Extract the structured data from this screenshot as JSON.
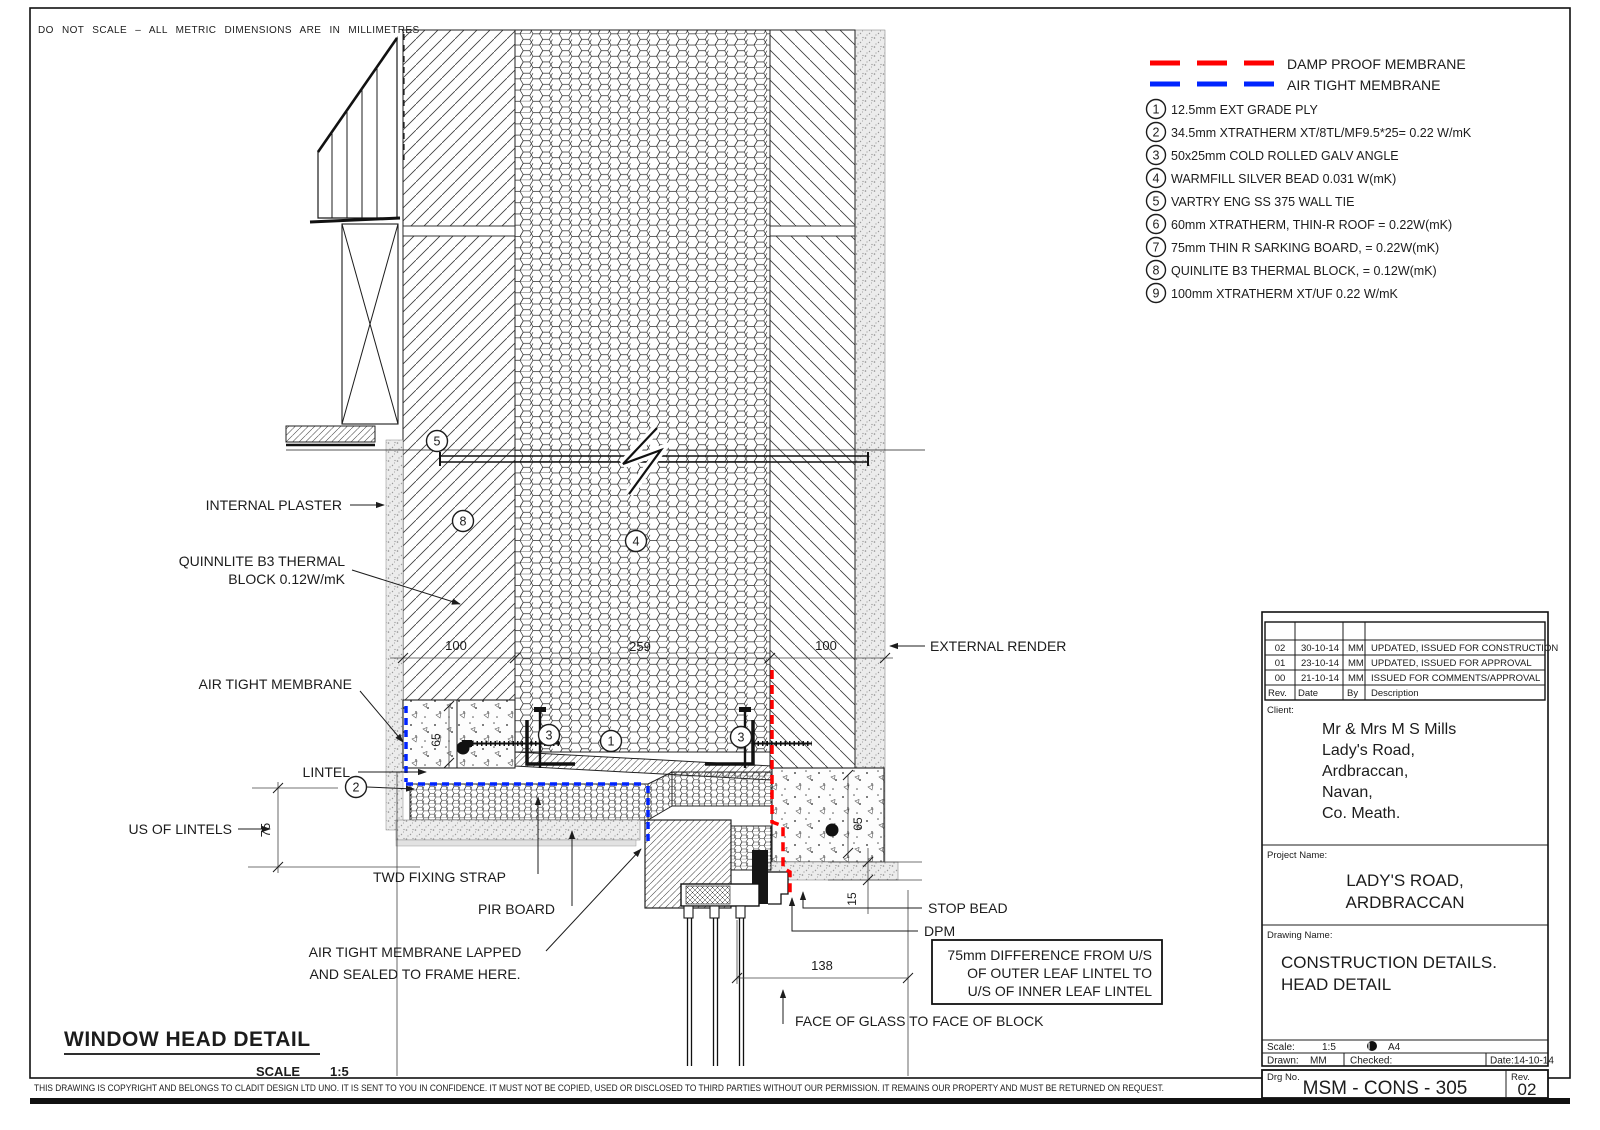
{
  "page": {
    "top_note": "DO NOT SCALE  –  ALL METRIC DIMENSIONS ARE IN MILLIMETRES",
    "copyright": "THIS DRAWING IS COPYRIGHT AND BELONGS TO CLADIT DESIGN LTD UNO.  IT IS SENT TO YOU IN CONFIDENCE.  IT MUST NOT BE COPIED, USED OR DISCLOSED TO THIRD PARTIES WITHOUT OUR PERMISSION.  IT REMAINS OUR PROPERTY AND MUST BE RETURNED ON REQUEST."
  },
  "legend": {
    "dpm_label": "DAMP PROOF MEMBRANE",
    "atm_label": "AIR TIGHT MEMBRANE",
    "dpm_color": "#ff0000",
    "atm_color": "#0024ff"
  },
  "notes": [
    {
      "num": "1",
      "text": "12.5mm EXT GRADE PLY"
    },
    {
      "num": "2",
      "text": "34.5mm XTRATHERM XT/8TL/MF9.5*25= 0.22 W/mK"
    },
    {
      "num": "3",
      "text": "50x25mm COLD ROLLED GALV ANGLE"
    },
    {
      "num": "4",
      "text": "WARMFILL SILVER BEAD 0.031 W(mK)"
    },
    {
      "num": "5",
      "text": "VARTRY ENG SS 375 WALL TIE"
    },
    {
      "num": "6",
      "text": "60mm XTRATHERM, THIN-R ROOF = 0.22W(mK)"
    },
    {
      "num": "7",
      "text": "75mm THIN R SARKING BOARD, = 0.22W(mK)"
    },
    {
      "num": "8",
      "text": "QUINLITE B3 THERMAL BLOCK, = 0.12W(mK)"
    },
    {
      "num": "9",
      "text": "100mm XTRATHERM XT/UF 0.22 W/mK"
    }
  ],
  "labels": {
    "internal_plaster": "INTERNAL PLASTER",
    "quinnlite_1": "QUINNLITE B3 THERMAL",
    "quinnlite_2": "BLOCK 0.12W/mK",
    "air_tight_membrane": "AIR TIGHT MEMBRANE",
    "lintel": "LINTEL",
    "us_of_lintels": "US OF LINTELS",
    "twd_fixing_strap": "TWD FIXING STRAP",
    "pir_board": "PIR BOARD",
    "atm_lapped_1": "AIR TIGHT MEMBRANE LAPPED",
    "atm_lapped_2": "AND SEALED TO FRAME HERE.",
    "external_render": "EXTERNAL RENDER",
    "stop_bead": "STOP BEAD",
    "dpm": "DPM",
    "diff_note_1": "75mm DIFFERENCE FROM U/S",
    "diff_note_2": "OF OUTER LEAF LINTEL TO",
    "diff_note_3": "U/S OF INNER LEAF LINTEL",
    "face_of_glass": "FACE OF GLASS TO FACE OF BLOCK"
  },
  "dims": {
    "inner_leaf": "100",
    "cavity": "259",
    "outer_leaf": "100",
    "offset": "75",
    "inner_lintel": "65",
    "outer_lintel": "65",
    "soffit": "15",
    "glass_block": "138"
  },
  "callouts": {
    "c1": "1",
    "c2": "2",
    "c3": "3",
    "c4": "4",
    "c5": "5",
    "c8": "8"
  },
  "title": {
    "heading": "WINDOW HEAD DETAIL",
    "scale_label": "SCALE",
    "scale_value": "1:5"
  },
  "tb": {
    "revisions": [
      {
        "rev": "02",
        "date": "30-10-14",
        "by": "MM",
        "desc": "UPDATED, ISSUED FOR CONSTRUCTION"
      },
      {
        "rev": "01",
        "date": "23-10-14",
        "by": "MM",
        "desc": "UPDATED, ISSUED FOR APPROVAL"
      },
      {
        "rev": "00",
        "date": "21-10-14",
        "by": "MM",
        "desc": "ISSUED FOR COMMENTS/APPROVAL"
      }
    ],
    "headers": {
      "rev": "Rev.",
      "date": "Date",
      "by": "By",
      "desc": "Description"
    },
    "client_label": "Client:",
    "client": [
      "Mr & Mrs M S Mills",
      "Lady's Road,",
      "Ardbraccan,",
      "Navan,",
      "Co. Meath."
    ],
    "project_label": "Project Name:",
    "project": [
      "LADY'S ROAD,",
      "ARDBRACCAN"
    ],
    "drawing_label": "Drawing Name:",
    "drawing": [
      "CONSTRUCTION DETAILS.",
      "HEAD DETAIL"
    ],
    "scale_label": "Scale:",
    "scale_value": "1:5",
    "paper": "A4",
    "drawn_label": "Drawn:",
    "drawn_value": "MM",
    "checked_label": "Checked:",
    "date_value": "Date:14-10-14",
    "drg_label": "Drg No.",
    "drg_value": "MSM - CONS - 305",
    "rev_label": "Rev.",
    "rev_value": "02"
  }
}
